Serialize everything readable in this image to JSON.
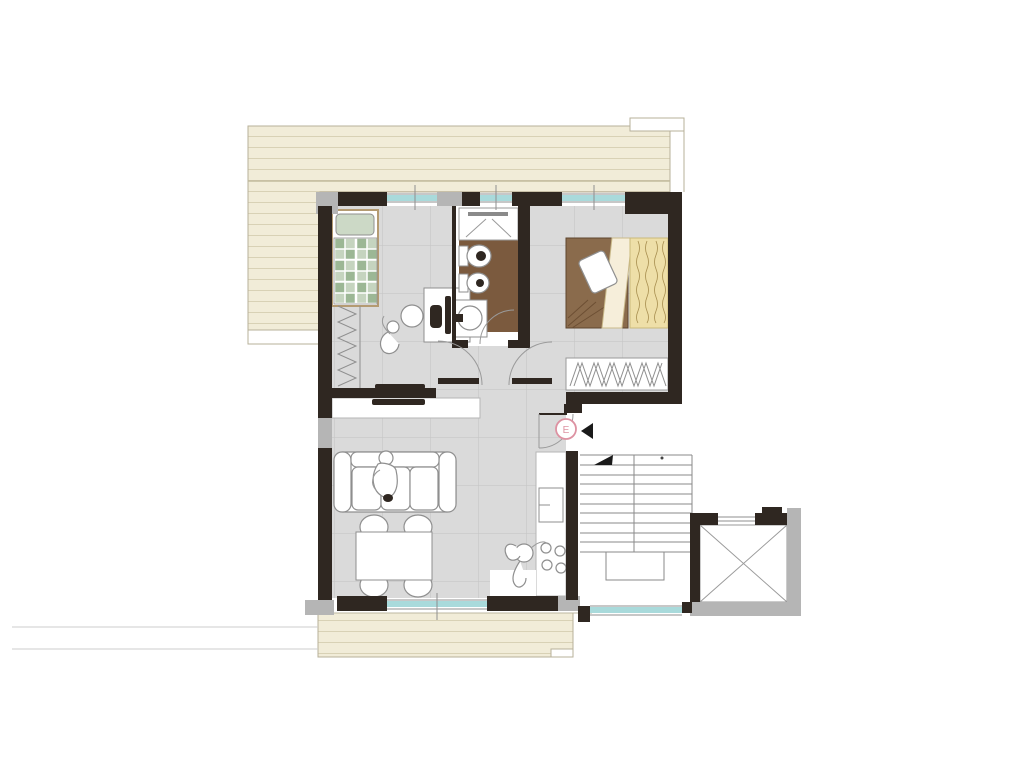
{
  "title": "apartment-floor-plan",
  "entrance": {
    "label": "E"
  },
  "symbols": {
    "entrance_marker": "E",
    "entrance_arrow": "left-triangle",
    "stairs_direction_arrow": "up-triangle",
    "elevator_cross": "x-diagonals"
  },
  "colors": {
    "wall": "#2f2721",
    "wall_light": "#b5b5b5",
    "floor": "#dadada",
    "floor_grid": "#c3c3c3",
    "terrace": "#f1ecd8",
    "terrace_stripe": "#d8d1b5",
    "bath_floor": "#7b5a3e",
    "window": "#a9dadb",
    "bed_pillow_green": "#ccd9c6",
    "bed_blanket_green": "#c5d4bf",
    "bed_blanket_green_dark": "#9cb795",
    "bed_cover_brown": "#8a6b4c",
    "bed_cover_yellow": "#eedfa8",
    "bed_fold_pale": "#f6eeda",
    "accent_pink": "#dd92a2",
    "sketch_line": "#8f8f8f"
  }
}
